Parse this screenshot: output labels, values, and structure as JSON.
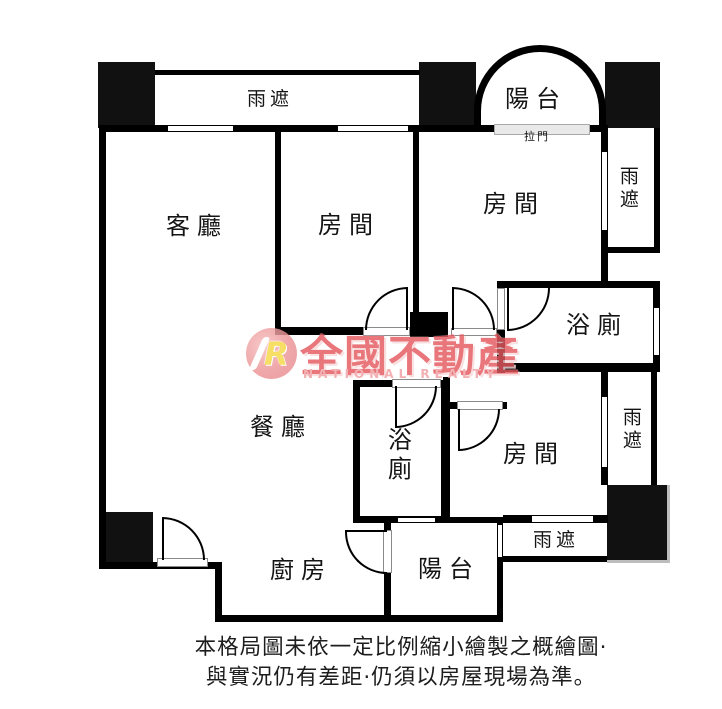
{
  "rooms": {
    "living": {
      "label": "客廳"
    },
    "bedroom_mid": {
      "label": "房間"
    },
    "bedroom_top_right": {
      "label": "房間"
    },
    "bedroom_bottom_right": {
      "label": "房間"
    },
    "bath_upper": {
      "label": "浴廁"
    },
    "bath_lower": {
      "label": "浴廁"
    },
    "dining": {
      "label": "餐廳"
    },
    "kitchen": {
      "label": "廚房"
    },
    "balcony_top": {
      "label": "陽台"
    },
    "balcony_bottom": {
      "label": "陽台"
    },
    "canopy_top": {
      "label": "雨遮"
    },
    "canopy_right_upper": {
      "label": "雨遮"
    },
    "canopy_right_lower": {
      "label": "雨遮"
    },
    "canopy_bottom": {
      "label": "雨遮"
    },
    "sliding_door": {
      "label": "拉門"
    }
  },
  "watermark": {
    "logo_letter": "R",
    "brand": "全國不動產",
    "brand_sub": "NATIONAL REALTY"
  },
  "disclaimer": {
    "line1": "本格局圖未依一定比例縮小繪製之概繪圖·",
    "line2": "與實況仍有差距·仍須以房屋現場為準。"
  },
  "colors": {
    "wall": "#000000",
    "brand_red": "#e4585e",
    "brand_pink": "#f09fa3",
    "logo_yellow": "#f6d844",
    "sliding_door_fill": "#e9e9e9"
  }
}
